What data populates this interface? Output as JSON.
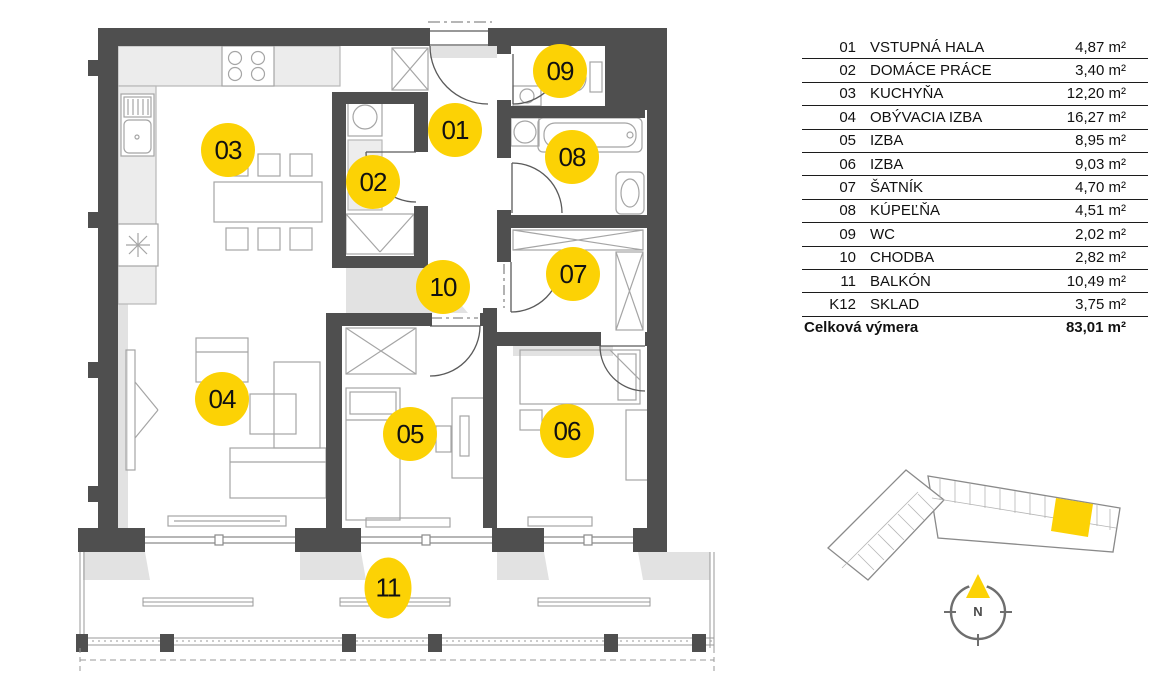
{
  "colors": {
    "accent_yellow": "#FCD205",
    "wall_dark": "#4F4F4F",
    "shadow_gray": "#E2E2E2",
    "line_gray": "#A5A5A5",
    "text_dark": "#111111"
  },
  "legend": {
    "rows": [
      {
        "num": "01",
        "name": "VSTUPNÁ HALA",
        "area": "4,87",
        "unit": "m²"
      },
      {
        "num": "02",
        "name": "DOMÁCE PRÁCE",
        "area": "3,40",
        "unit": "m²"
      },
      {
        "num": "03",
        "name": "KUCHYŇA",
        "area": "12,20",
        "unit": "m²"
      },
      {
        "num": "04",
        "name": "OBÝVACIA IZBA",
        "area": "16,27",
        "unit": "m²"
      },
      {
        "num": "05",
        "name": "IZBA",
        "area": "8,95",
        "unit": "m²"
      },
      {
        "num": "06",
        "name": "IZBA",
        "area": "9,03",
        "unit": "m²"
      },
      {
        "num": "07",
        "name": "ŠATNÍK",
        "area": "4,70",
        "unit": "m²"
      },
      {
        "num": "08",
        "name": "KÚPEĽŇA",
        "area": "4,51",
        "unit": "m²"
      },
      {
        "num": "09",
        "name": "WC",
        "area": "2,02",
        "unit": "m²"
      },
      {
        "num": "10",
        "name": "CHODBA",
        "area": "2,82",
        "unit": "m²"
      },
      {
        "num": "11",
        "name": "BALKÓN",
        "area": "10,49",
        "unit": "m²"
      },
      {
        "num": "K12",
        "name": "SKLAD",
        "area": "3,75",
        "unit": "m²"
      }
    ],
    "total": {
      "label": "Celková výmera",
      "area": "83,01",
      "unit": "m²"
    }
  },
  "floor_plan": {
    "markers": [
      {
        "label": "01",
        "x": 455,
        "y": 130,
        "shape": "circle"
      },
      {
        "label": "02",
        "x": 373,
        "y": 182,
        "shape": "circle"
      },
      {
        "label": "03",
        "x": 228,
        "y": 150,
        "shape": "circle"
      },
      {
        "label": "04",
        "x": 222,
        "y": 399,
        "shape": "circle"
      },
      {
        "label": "05",
        "x": 410,
        "y": 434,
        "shape": "circle"
      },
      {
        "label": "06",
        "x": 567,
        "y": 431,
        "shape": "circle"
      },
      {
        "label": "07",
        "x": 573,
        "y": 274,
        "shape": "circle"
      },
      {
        "label": "08",
        "x": 572,
        "y": 157,
        "shape": "circle"
      },
      {
        "label": "09",
        "x": 560,
        "y": 71,
        "shape": "circle"
      },
      {
        "label": "10",
        "x": 443,
        "y": 287,
        "shape": "circle"
      },
      {
        "label": "11",
        "x": 388,
        "y": 588,
        "shape": "ellipse"
      }
    ]
  },
  "compass": {
    "label": "N"
  }
}
